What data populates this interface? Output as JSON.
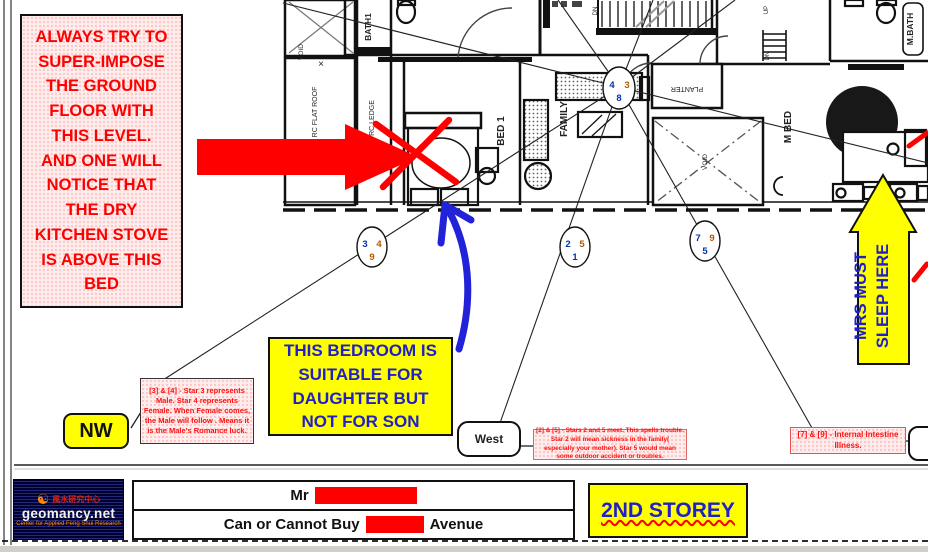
{
  "title_note": {
    "text": "ALWAYS TRY TO SUPER-IMPOSE THE GROUND FLOOR WITH THIS LEVEL. AND ONE WILL NOTICE THAT THE DRY KITCHEN STOVE IS ABOVE THIS BED"
  },
  "bedroom_note": {
    "text": "THIS BEDROOM IS SUITABLE FOR DAUGHTER BUT NOT FOR SON"
  },
  "mrs_arrow": {
    "line1": "MRS MUST",
    "line2": "SLEEP HERE"
  },
  "compass": {
    "nw": "NW",
    "west": "West"
  },
  "annotations": {
    "star_3_4": "[3] & [4] - Star 3 represents Male. Star 4 represents Female. When Female comes, the Male will follow . Means it is the Male's Romance luck.",
    "star_2_5": "[2] & [5] - Stars 2 and 5 meet. This spells trouble. Star 2 will mean sickness in the family( especially your mother). Star 5 would mean some outdoor accident or troubles.",
    "star_7_9": "[7] & [9] - Internal Intestine Illness."
  },
  "plan": {
    "room_labels": {
      "void_top": "VOID",
      "void_x_mark": "×",
      "bath1": "BATH1",
      "rc_flat_roof": "RC FLAT ROOF",
      "rc_ledge": "RC LEDGE",
      "bed1": "BED 1",
      "family": "FAMILY",
      "planter": "PLANTER",
      "void_center": "VOID",
      "m_bed": "M BED",
      "m_bath": "M.BATH",
      "stairs_up": "UP",
      "stairs_dn": "DN"
    },
    "star_circles": {
      "center": {
        "left": "4",
        "right": "3",
        "bottom": "8"
      },
      "nw": {
        "left": "3",
        "right": "4",
        "bottom": "9"
      },
      "west": {
        "left": "2",
        "right": "5",
        "bottom": "1"
      },
      "se": {
        "left": "7",
        "right": "9",
        "bottom": "5"
      }
    }
  },
  "footer": {
    "logo": {
      "yinyang": "☯",
      "chinese": "風水研究中心",
      "brand": "geomancy.net",
      "tagline": "Center for Applied Feng Shui Research"
    },
    "client": {
      "salutation": "Mr",
      "line2_prefix": "Can or Cannot Buy",
      "line2_suffix": "Avenue"
    },
    "storey": "2ND STOREY"
  },
  "palette": {
    "accent_red": "#ff0000",
    "highlight_yellow": "#ffff00",
    "note_blue": "#2020c8",
    "pink_note_bg": "#ffecec",
    "star_blue": "#0033aa",
    "star_orange": "#b35900",
    "arrow_blue": "#2222d8"
  }
}
